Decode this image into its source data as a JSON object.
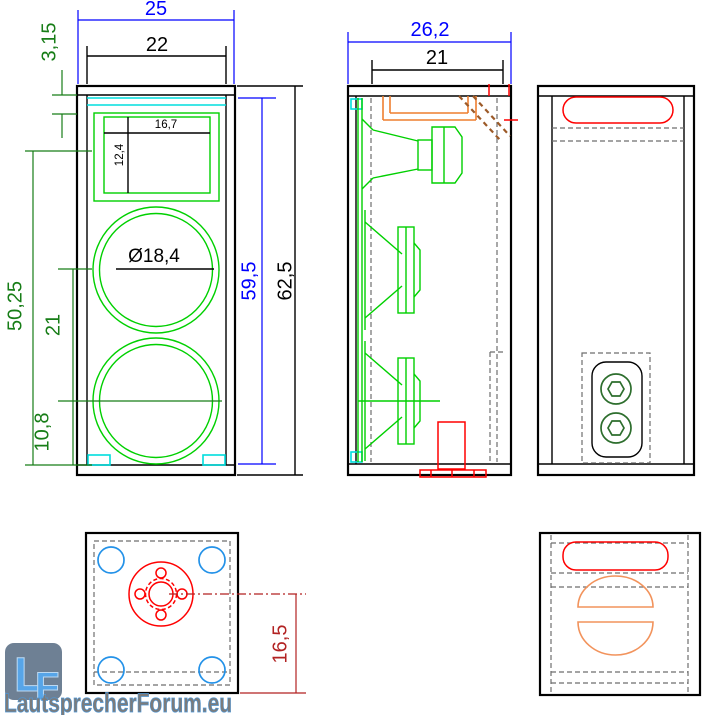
{
  "front_view": {
    "dim_outer_width": "25",
    "dim_inner_width": "22",
    "dim_top_panel_to_cutout": "3,15",
    "dim_tweeter_cutout_width": "16,7",
    "dim_tweeter_cutout_height": "12,4",
    "dim_woofer_diameter": "Ø18,4",
    "dim_tweeter_to_bottom": "50,25",
    "dim_woofer_center_spacing": "21",
    "dim_woofer_center_to_bottom": "10,8",
    "dim_inner_height": "59,5",
    "dim_outer_height": "62,5"
  },
  "side_view": {
    "dim_outer_depth": "26,2",
    "dim_inner_depth": "21"
  },
  "bottom_view": {
    "dim_flange_center_to_back": "16,5"
  },
  "branding": {
    "logo_letter_l": "L",
    "logo_letter_f": "F",
    "site_name": "LautsprecherForum.eu"
  },
  "colors": {
    "dimension_blue": "#0000ff",
    "dimension_black": "#000000",
    "dimension_green": "#177d17",
    "dimension_dark_red": "#b22222",
    "drawing_green": "#00d000",
    "drawing_cyan": "#00dede",
    "drawing_red": "#ff0000",
    "drawing_orange": "#ee7f2f",
    "drawing_orange_light": "#f2935c",
    "drawing_brown_dashed": "#9c5a28",
    "drawing_gray_dashed": "#6e6e6e",
    "feet_blue": "#2492e8",
    "terminal_post_green": "#2d6e2d",
    "logo_background": "#6e8094",
    "logo_letter_blue": "#57a5e8",
    "watermark_gray": "#7b7b7b"
  }
}
